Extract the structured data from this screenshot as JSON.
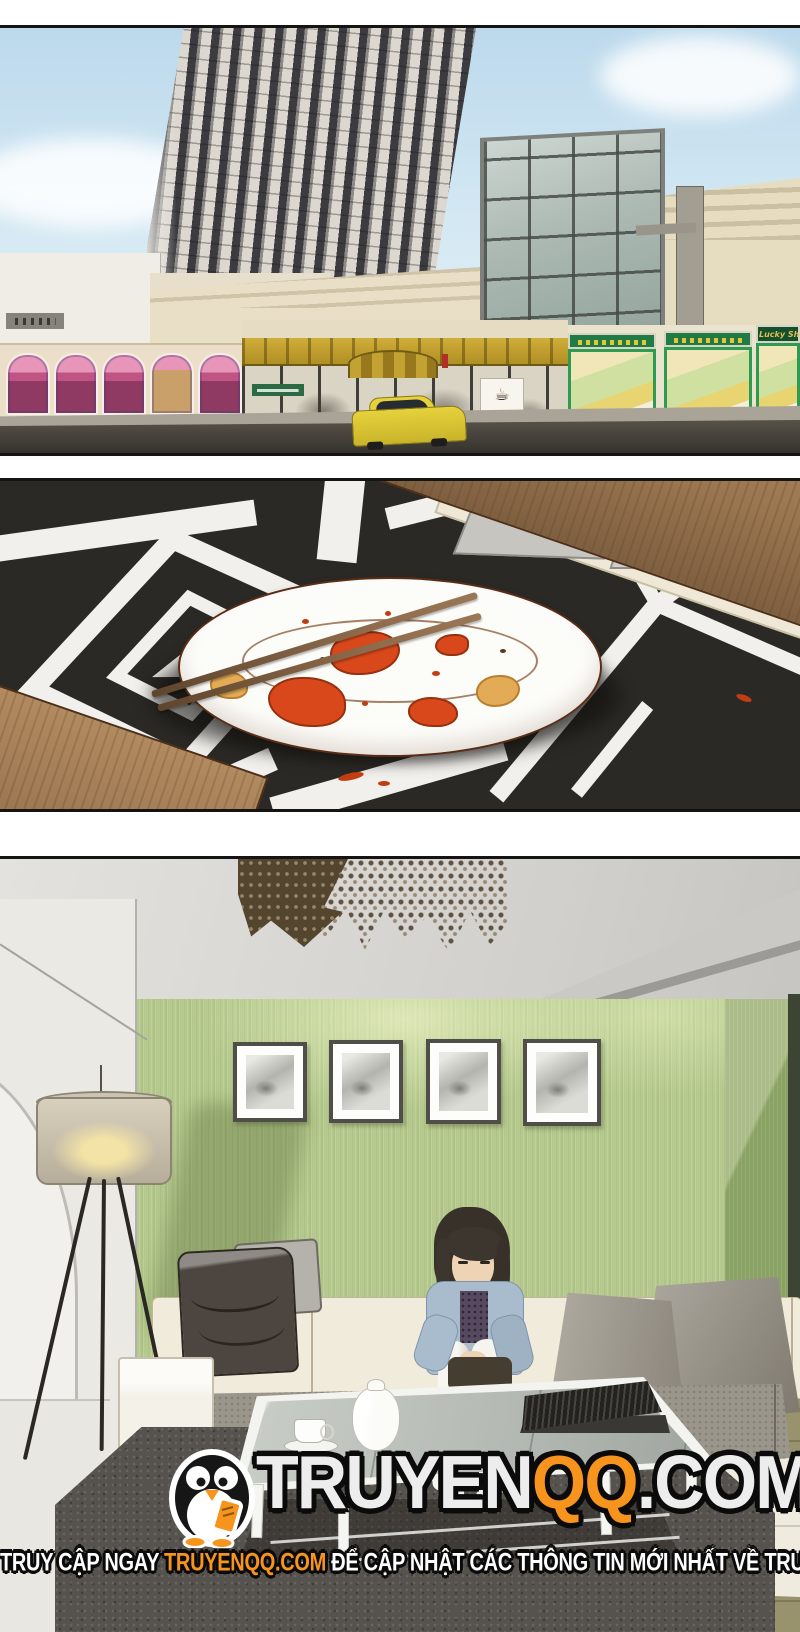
{
  "page": {
    "kind": "manga page",
    "width": 800,
    "height": 1632,
    "background": "#ffffff"
  },
  "panels": {
    "city": {
      "alt": "Low-angle view of a striped high-rise tower above a beige mall with storefronts and a yellow taxi on the street",
      "lucky_shop_sign": "Lucky Shop",
      "coffee_icon": "☕"
    },
    "plate": {
      "alt": "Empty white plate with red sauce smears and a pair of wooden chopsticks on a black placemat with white geometric pattern beside a wooden table edge"
    },
    "living_room": {
      "alt": "Green-walled living room with beaded chandelier, four framed prints, tripod floor lamp, cream sectional sofa with a dark bag, a seated woman and a glass coffee table on a dark rug"
    }
  },
  "watermark": {
    "logo": "penguin-mascot",
    "title_part_truyen": "TRUYEN",
    "title_part_qq": "QQ",
    "title_part_com": ".COM",
    "tagline_prefix": "TRUY CẬP NGAY ",
    "tagline_link": "TRUYENQQ.COM",
    "tagline_suffix": " ĐỂ CẬP NHẬT CÁC THÔNG TIN MỚI NHẤT VỀ TRUYỆN",
    "accent_color": "#f7941d",
    "text_color": "#ffffff",
    "outline_color": "#0b0b0b"
  }
}
